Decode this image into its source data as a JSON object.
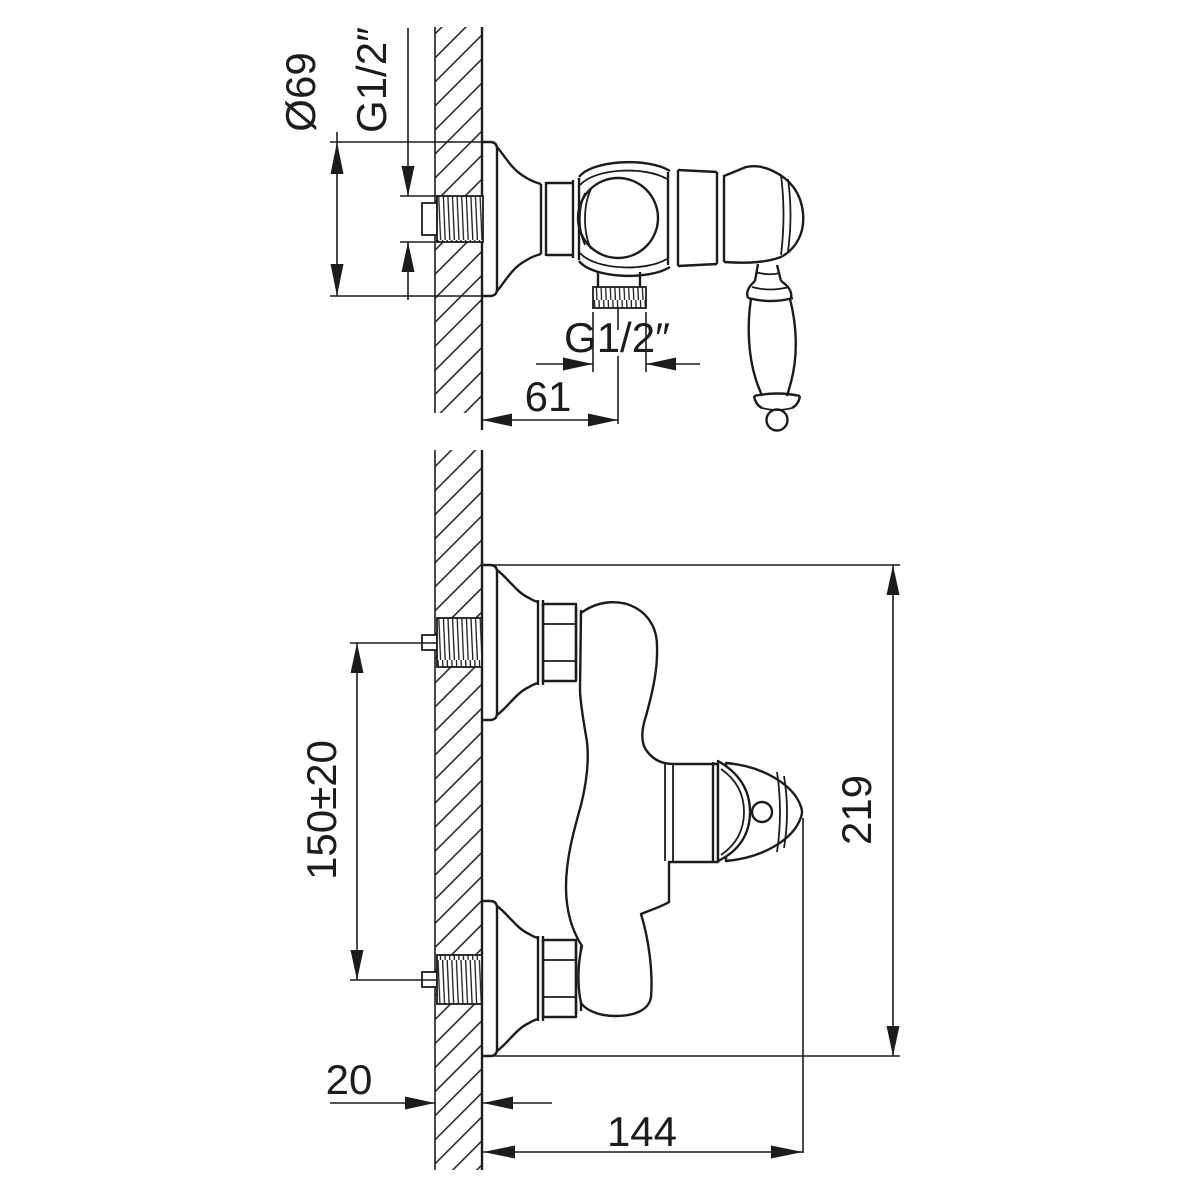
{
  "drawing": {
    "background": "#ffffff",
    "line_color": "#1c1c1c",
    "description": "Installation dimension drawing of a wall-mounted single-lever shower mixer, side view and front view",
    "views": {
      "side_view": {
        "dimensions": {
          "escutcheon_diameter": "Ø69",
          "wall_thread": "G1/2″",
          "outlet_thread": "G1/2″",
          "wall_to_outlet_center": "61"
        }
      },
      "front_view": {
        "dimensions": {
          "inlet_spacing": "150±20",
          "overall_height": "219",
          "wall_thickness": "20",
          "overall_width": "144"
        }
      }
    }
  }
}
